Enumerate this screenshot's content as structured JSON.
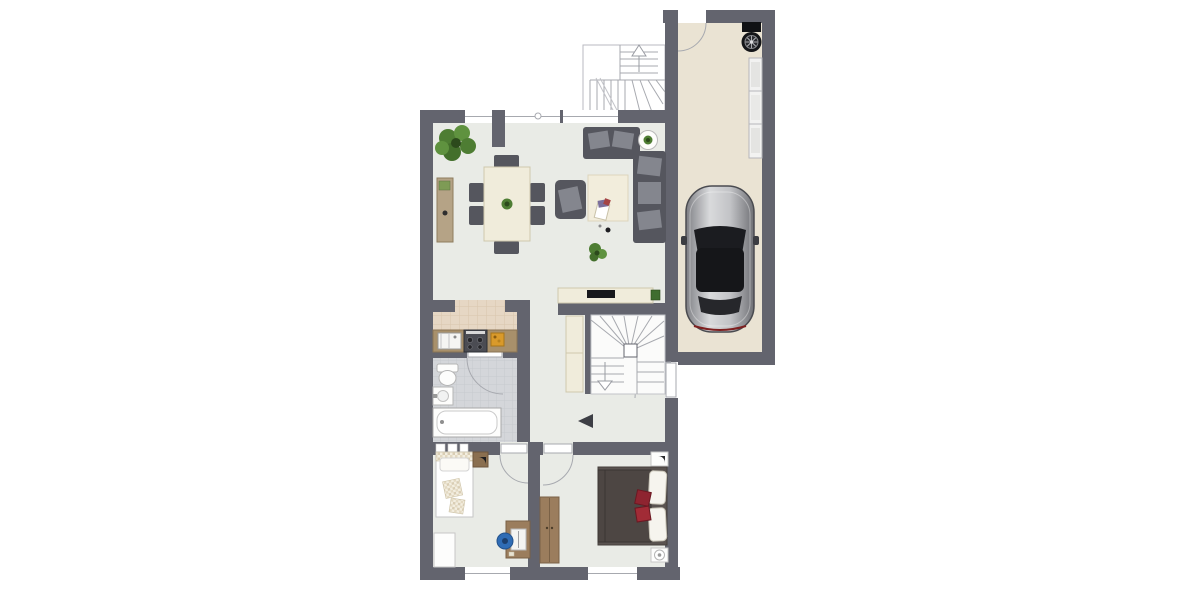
{
  "image_type": "architectural floor plan, top-down view, no visible text labels",
  "colors": {
    "wall": "#63646e",
    "floor": "#e9ebe6",
    "garage_floor": "#eae3d3",
    "kitchen_floor": "#e6d7c4",
    "kitchen_grid": "#d8c5ad",
    "bath_floor": "#d4d6da",
    "bath_grid": "#c6c9ce",
    "line": "#a7a9af",
    "sofa": "#55565e",
    "cushion": "#84868e",
    "cream": "#f0ecdb",
    "cream_edge": "#cfc8ad",
    "wood": "#9b7d5d",
    "wood_dark": "#7a6146",
    "sideboard": "#b5a386",
    "counter": "#a8906b",
    "plant": "#4e7d33",
    "plant_light": "#5f923f",
    "plant_dark": "#2c4a1c",
    "car_body_light": "#d9dadc",
    "car_body_dark": "#85868b",
    "car_glass": "#1b1c20",
    "accent_red": "#8e2430",
    "chair_blue": "#2f6cb5",
    "stove": "#4b4c53",
    "board_orange": "#d99a2b",
    "bed_blanket": "#4d4643",
    "knit_a": "#e3d9c2",
    "knit_b": "#f3eee0"
  },
  "plan": {
    "rooms": [
      {
        "id": "living-dining-room",
        "floor": "light gray",
        "furniture": [
          "large-plant",
          "sideboard",
          "dining-table",
          "six-chairs",
          "armchair",
          "two-seat-sofa",
          "three-seat-sofa",
          "side-table-with-plant",
          "rug",
          "small-plant",
          "tv-lowboard"
        ]
      },
      {
        "id": "kitchen",
        "floor": "beige tiles",
        "furniture": [
          "counter",
          "sink",
          "stove",
          "cutting-board"
        ]
      },
      {
        "id": "bathroom",
        "floor": "gray tiles",
        "furniture": [
          "toilet",
          "washbasin",
          "bathtub",
          "radiator"
        ]
      },
      {
        "id": "hallway",
        "floor": "light gray",
        "furniture": [
          "winder-staircase-down",
          "hall-cabinet",
          "entrance-arrow"
        ]
      },
      {
        "id": "child-room",
        "floor": "light gray",
        "furniture": [
          "single-bed",
          "nightstand",
          "white-dresser",
          "desk",
          "laptop",
          "blue-office-chair"
        ]
      },
      {
        "id": "bedroom",
        "floor": "light gray",
        "furniture": [
          "double-bed",
          "red-pillows",
          "wardrobe",
          "nightstand-top",
          "nightstand-with-lamp"
        ]
      },
      {
        "id": "garage",
        "floor": "beige",
        "furniture": [
          "car-top-view",
          "spare-wheel",
          "shelf-unit"
        ]
      },
      {
        "id": "exterior-staircase",
        "floor": "white",
        "furniture": [
          "stair-flight-up-arrow"
        ]
      }
    ],
    "doors": [
      "garage-entry-door",
      "bathroom-door",
      "main-entrance-door",
      "child-room-door",
      "bedroom-door"
    ],
    "windows": [
      "living-window-left",
      "living-window-mid",
      "living-window-right",
      "child-room-window",
      "bedroom-window"
    ]
  }
}
